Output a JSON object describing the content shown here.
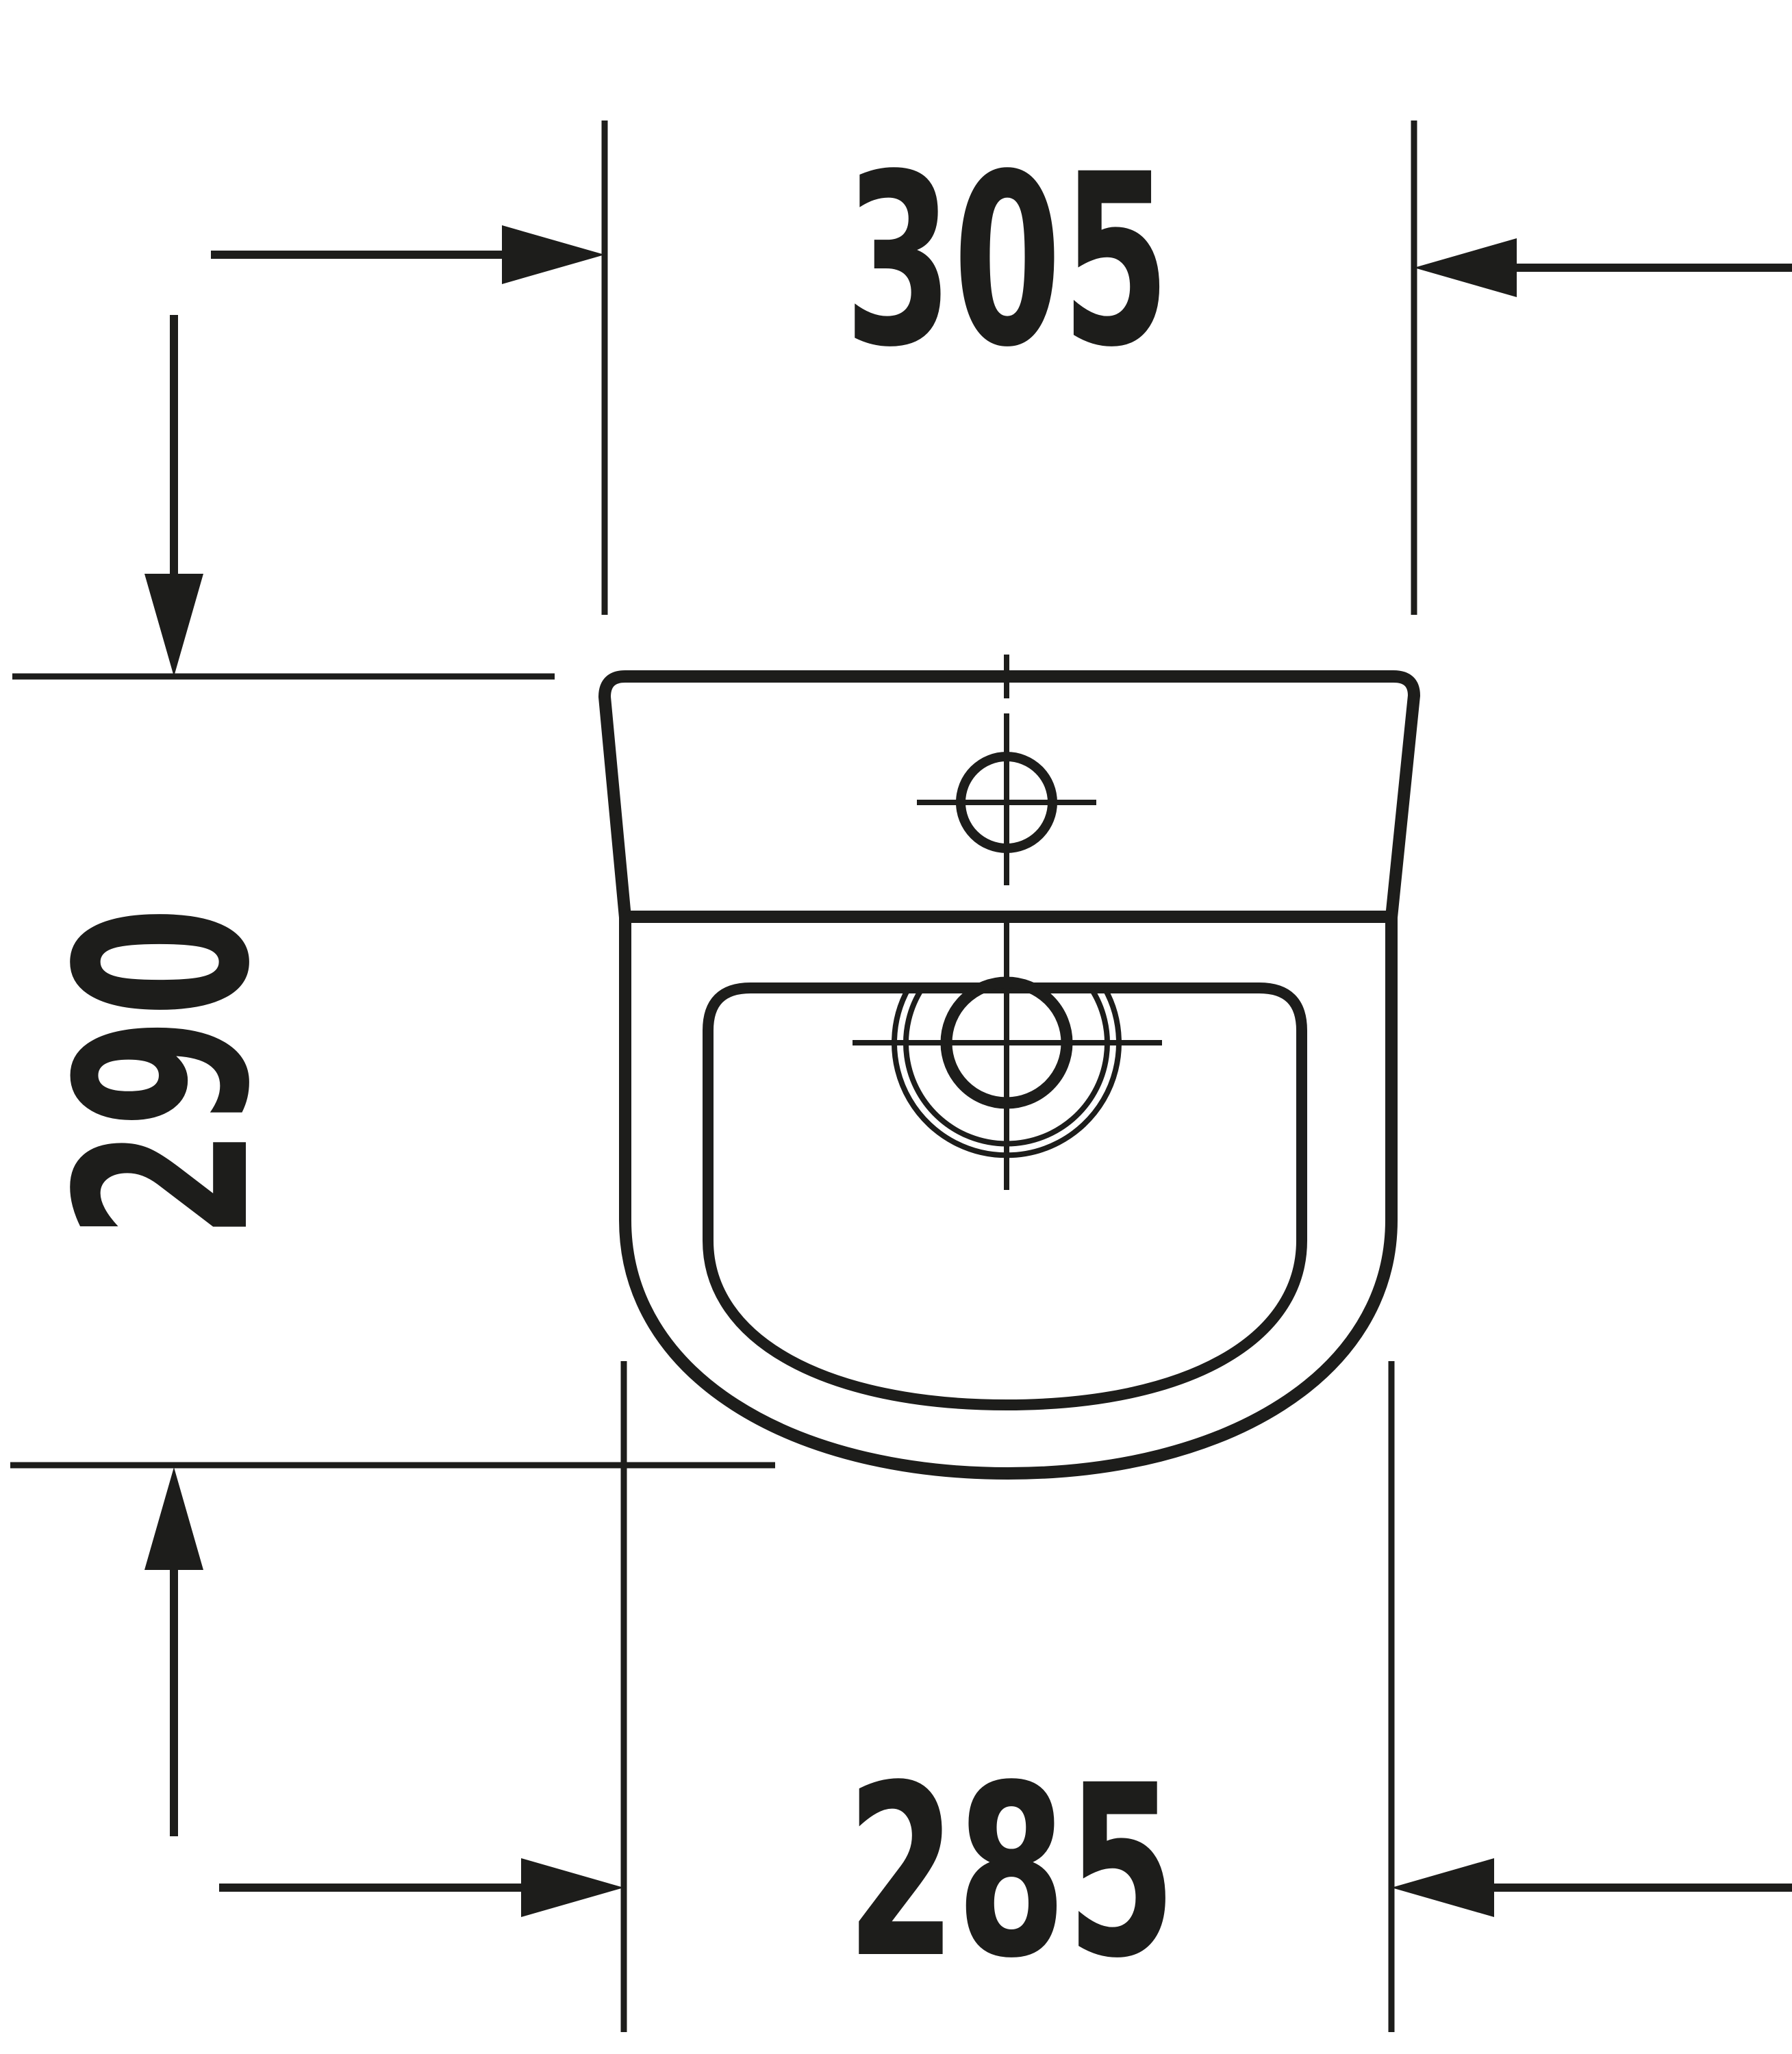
{
  "drawing": {
    "title": "Urinal technical drawing, front view",
    "kind": "dimension-drawing",
    "units": "mm",
    "colors": {
      "line": "#1d1d1b",
      "background": "#ffffff"
    },
    "dimensions": {
      "top_width": {
        "value": "305",
        "orientation": "horizontal",
        "position": "top"
      },
      "left_height": {
        "value": "290",
        "orientation": "vertical-rotated",
        "position": "left"
      },
      "bottom_width": {
        "value": "285",
        "orientation": "horizontal",
        "position": "bottom"
      }
    },
    "features": [
      "outer-body-outline",
      "rim-line",
      "inner-bowl",
      "mounting-hole-crosshair",
      "drain-outlet-crosshair",
      "center-line"
    ]
  }
}
